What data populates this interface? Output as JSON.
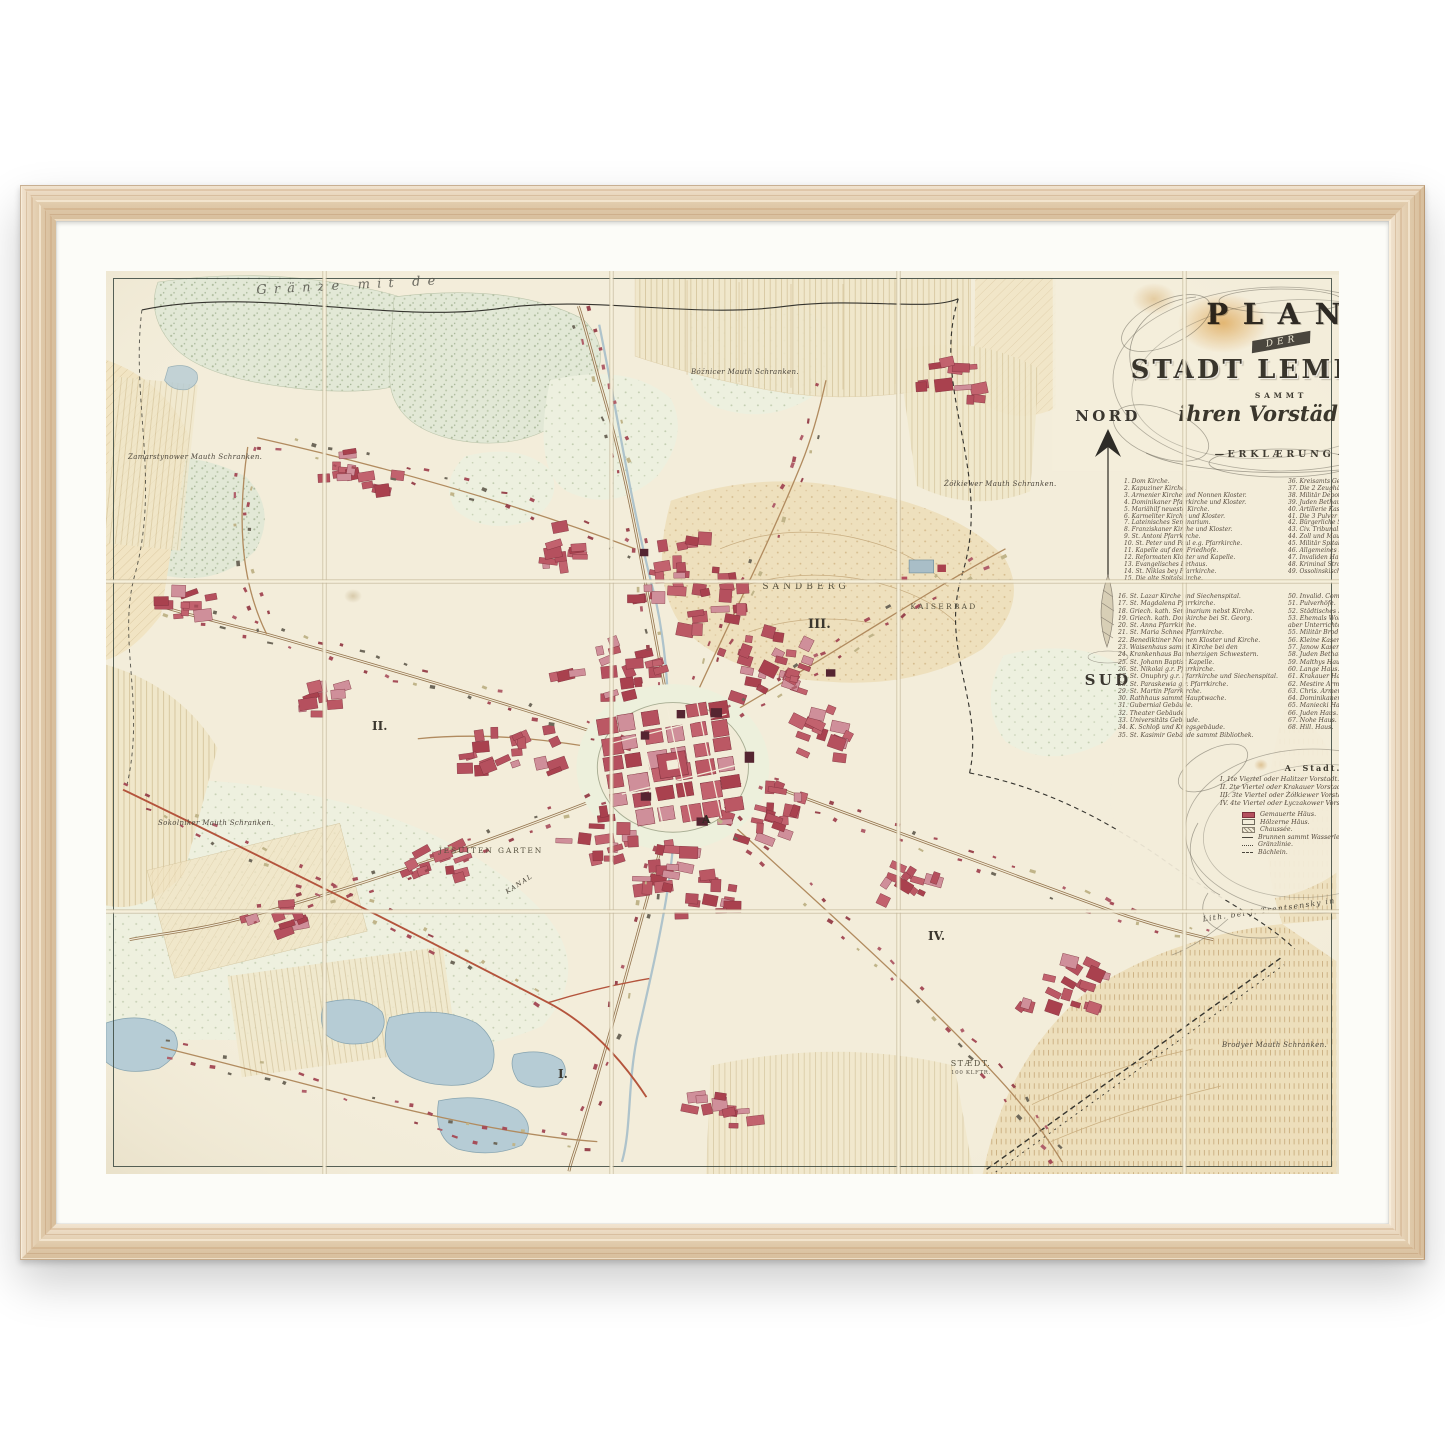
{
  "title": {
    "plan": "PLAN",
    "der": "DER",
    "stadt": "STADT LEMBERG",
    "sammt": "SAMMT",
    "vorstaedten": "ihren Vorstädten.",
    "erklaerung": "ERKLÆRUNG"
  },
  "compass": {
    "north": "NORD",
    "south": "SUD"
  },
  "map_labels": {
    "granze": "Gränze mit de",
    "sandberg": "SANDBERG",
    "kaiserbad": "KAISERBAD",
    "district_1": "I.",
    "district_2": "II.",
    "district_3": "III.",
    "district_4": "IV.",
    "city_a": "A",
    "jesuiten_garten": "JESUITEN GARTEN",
    "kanal": "KANAL",
    "staedt": "STÆDT.",
    "staedt_sub": "100 KLFTR.",
    "cetnerowka": "CETNERÓWKA.",
    "mauth": {
      "zamarstynow": "Zamarstynower Mauth Schranken.",
      "boznicer": "Bóźnicer Mauth Schranken.",
      "zolkiewer": "Żółkiewer Mauth Schranken.",
      "stryjer": "Stryjer Mauth Schranken.",
      "brodyer": "Brodyer Mauth Schranken.",
      "sokolniker": "Sokolniker Mauth Schranken."
    }
  },
  "legend": {
    "col1": [
      "1. Dom Kirche.",
      "2. Kapuziner Kirche.",
      "3. Armenier Kirche und Nonnen Kloster.",
      "4. Dominikaner Pfarrkirche und Kloster.",
      "5. Mariähilf neueste Kirche.",
      "6. Karmeliter Kirche und Kloster.",
      "7. Lateinisches Seminarium.",
      "8. Franziskaner Kirche und Kloster.",
      "9. St. Antoni Pfarrkirche.",
      "10. St. Peter und Paul e.g. Pfarrkirche.",
      "11. Kapelle auf dem Friedhofe.",
      "12. Reformaten Kloster und Kapelle.",
      "13. Evangelisches Bethaus.",
      "14. St. Niklas bey Pfarrkirche.",
      "15. Die alte Spitalskirche."
    ],
    "col2": [
      "36. Kreisamts Gebäud.",
      "37. Die 2 Zeughäuser sammt Depot.",
      "38. Militär Depot.",
      "39. Juden Bethaus.",
      "40. Artillerie Kasernen.",
      "41. Die 3 Pulver Depots.",
      "42. Bürgerliche Schiess Statt.",
      "43. Civ. Tribunal.",
      "44. Zoll und Mauth Gefällen Administration.",
      "45. Militär Spital.",
      "46. Allgemeines Krankenhaus.",
      "47. Invaliden Hauptspital.",
      "48. Kriminal Strafgericht.",
      "49. Ossolinskisches National Museum samt Bibliothek."
    ],
    "col3": [
      "16. St. Lazar Kirche und Siechenspital.",
      "17. St. Magdalena Pfarrkirche.",
      "18. Griech. kath. Seminarium nebst Kirche.",
      "19. Griech. kath. Domkirche bei St. Georg.",
      "20. St. Anna Pfarrkirche.",
      "21. St. Maria Schnee Pfarrkirche.",
      "22. Benediktiner Nonnen Kloster und Kirche.",
      "23. Waisenhaus sammt Kirche bei den",
      "24. Krankenhaus Barmherzigen Schwestern.",
      "25. St. Johann Baptist Kapelle.",
      "26. St. Nikolai g.r. Pfarrkirche.",
      "27. St. Onuphry g.r. Pfarrkirche und Siechenspital.",
      "28. St. Paraskewia g.r. Pfarrkirche.",
      "29. St. Martin Pfarrkirche.",
      "30. Rathhaus sammt Hauptwache.",
      "31. Gubernial Gebäude.",
      "32. Theater Gebäude.",
      "33. Universitäts Gebäude.",
      "34. K. Schloß und Kriegsgebäude.",
      "35. St. Kasimir Gebäude sammt Bibliothek."
    ],
    "col4": [
      "50. Invalid. Commando Gebäude.",
      "51. Pulverhöfe.",
      "52. Städtisches Krankenhaus und Begräbnisplatz.",
      "53. Ehemals Wolthausischer Garten jetzt zum priv.",
      "aber Unterrichte der Landwirthschaft bestimmt.",
      "55. Militär Brod Backhaus.",
      "56. Kleine Kasernen.",
      "57. Janow Kasernen.",
      "58. Juden Bethaus.",
      "59. Malthys Haus.",
      "60. Lange Haus.",
      "61. Krakauer Haus.",
      "62. Mestire Armenier Haus.",
      "63. Chris. Armenier Haus.",
      "64. Dominikaner Haus.",
      "65. Maniecki Haus.",
      "66. Juden Haus.",
      "67. Nohe Haus.",
      "68. Hill. Haus."
    ]
  },
  "key": {
    "city": "A. Stadt.",
    "quarters": [
      "I. 1te Viertel oder Halitzer Vorstadt.",
      "II. 2te Viertel oder Krakauer Vorstadt.",
      "III. 3te Viertel oder Żółkiewer Vorstadt.",
      "IV. 4te Viertel oder Łyczakower Vorstadt."
    ],
    "symbols": [
      {
        "swatch": "solid",
        "label": "Gemauerte Häus."
      },
      {
        "swatch": "outline",
        "label": "Hölzerne Häus."
      },
      {
        "swatch": "hatch",
        "label": "Chaussée."
      },
      {
        "swatch": "line",
        "label": "Brunnen sammt Wasserleitung."
      },
      {
        "swatch": "wavyline",
        "label": "Gränzlinie."
      },
      {
        "swatch": "dashline",
        "label": "Bächlein."
      }
    ],
    "imprint": "Lith. bei J. Trentsensky in Wien."
  },
  "colors": {
    "paper": "#f3edda",
    "wood_frame": "#e9d2b1",
    "building_red": "#b5505e",
    "water_blue": "#b6ccd5",
    "woods_green": "#e2e8d6",
    "fields_tan": "#eee0bd"
  }
}
